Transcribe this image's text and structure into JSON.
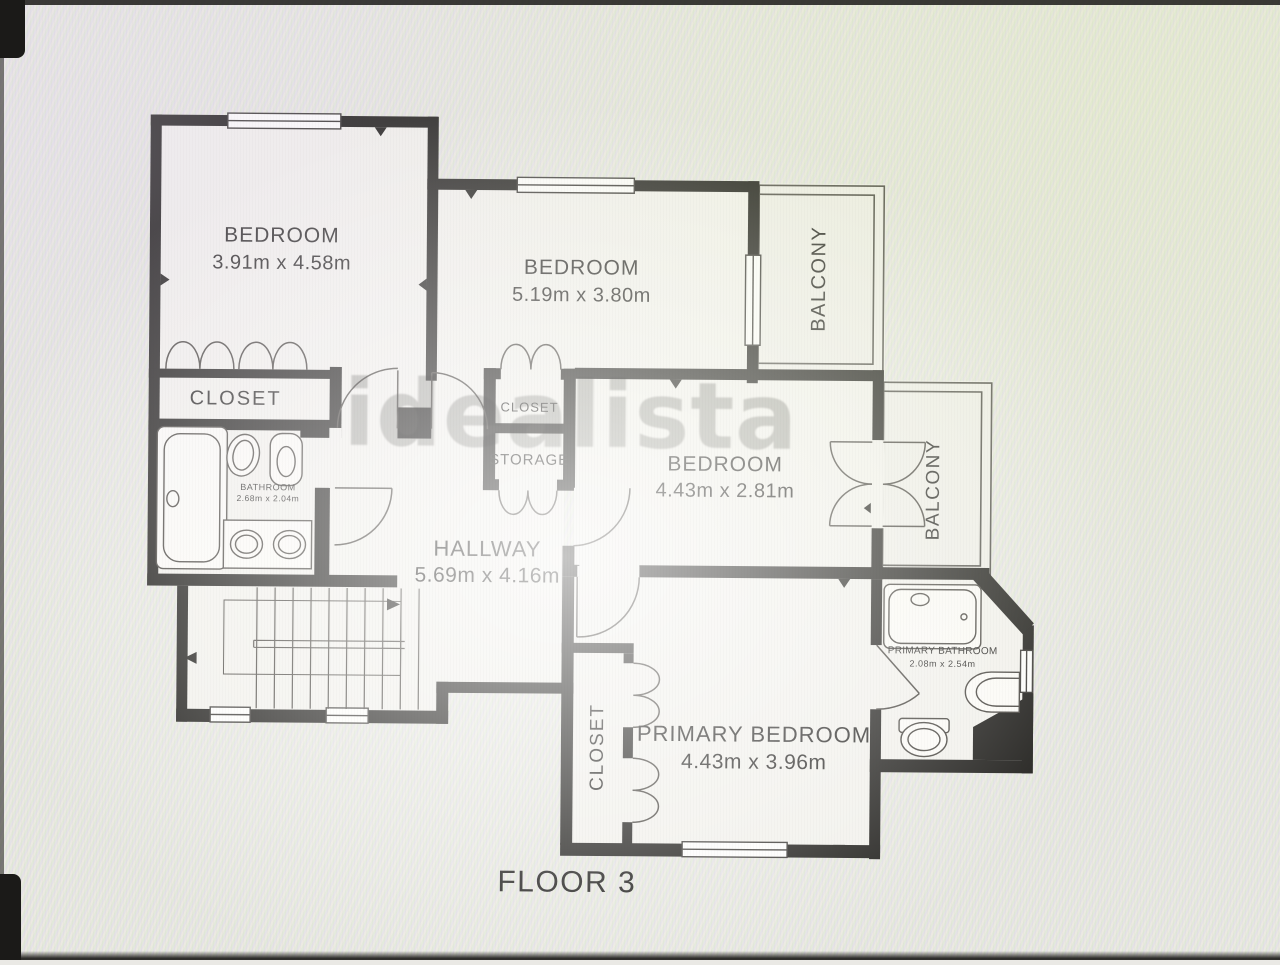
{
  "floor_label": "FLOOR 3",
  "watermark": "idealista",
  "rooms": {
    "bedroom_top_left": {
      "name": "BEDROOM",
      "dims": "3.91m x 4.58m"
    },
    "bedroom_top_mid": {
      "name": "BEDROOM",
      "dims": "5.19m x 3.80m"
    },
    "bedroom_mid_right": {
      "name": "BEDROOM",
      "dims": "4.43m x 2.81m"
    },
    "primary_bedroom": {
      "name": "PRIMARY BEDROOM",
      "dims": "4.43m x 3.96m"
    },
    "hallway": {
      "name": "HALLWAY",
      "dims": "5.69m x 4.16m"
    },
    "bathroom": {
      "name": "BATHROOM",
      "dims": "2.68m x 2.04m"
    },
    "primary_bathroom": {
      "name": "PRIMARY BATHROOM",
      "dims": "2.08m x 2.54m"
    },
    "closet_left": {
      "name": "CLOSET"
    },
    "closet_mid": {
      "name": "CLOSET"
    },
    "storage": {
      "name": "STORAGE"
    },
    "closet_primary": {
      "name": "CLOSET"
    },
    "balcony_top": {
      "name": "BALCONY"
    },
    "balcony_right": {
      "name": "BALCONY"
    }
  },
  "colors": {
    "wall": "#23221f",
    "line": "#4a4742",
    "text": "#2b2a28",
    "floor": "#f2f1ec",
    "background": "#eae9e5",
    "watermark_grey": "#7d7d78"
  }
}
